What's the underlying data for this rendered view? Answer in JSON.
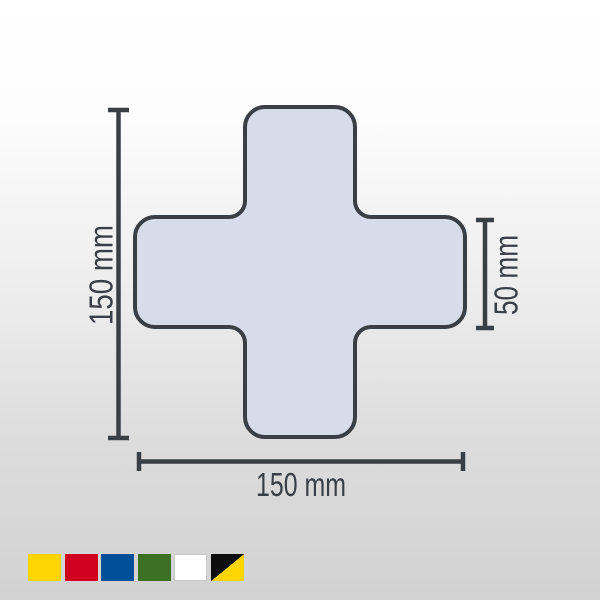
{
  "background": {
    "gradient_top": "#ffffff",
    "gradient_bottom": "#d2d2d2"
  },
  "diagram": {
    "shape_name": "cross",
    "shape_fill": "#d6dcea",
    "shape_outline": "#3a3f46",
    "dimension_color": "#3a3f46",
    "labels": {
      "height": "150 mm",
      "width": "150 mm",
      "arm_width": "50 mm"
    }
  },
  "color_swatches": {
    "items": [
      {
        "name": "yellow",
        "color": "#ffd500"
      },
      {
        "name": "red",
        "color": "#d0011e"
      },
      {
        "name": "blue",
        "color": "#004f97"
      },
      {
        "name": "green",
        "color": "#3c7022"
      },
      {
        "name": "white",
        "color": "#ffffff",
        "border": "#c8c8c8"
      },
      {
        "name": "black-yellow",
        "color": "#0d0d0d",
        "color2": "#ffd500"
      }
    ]
  }
}
